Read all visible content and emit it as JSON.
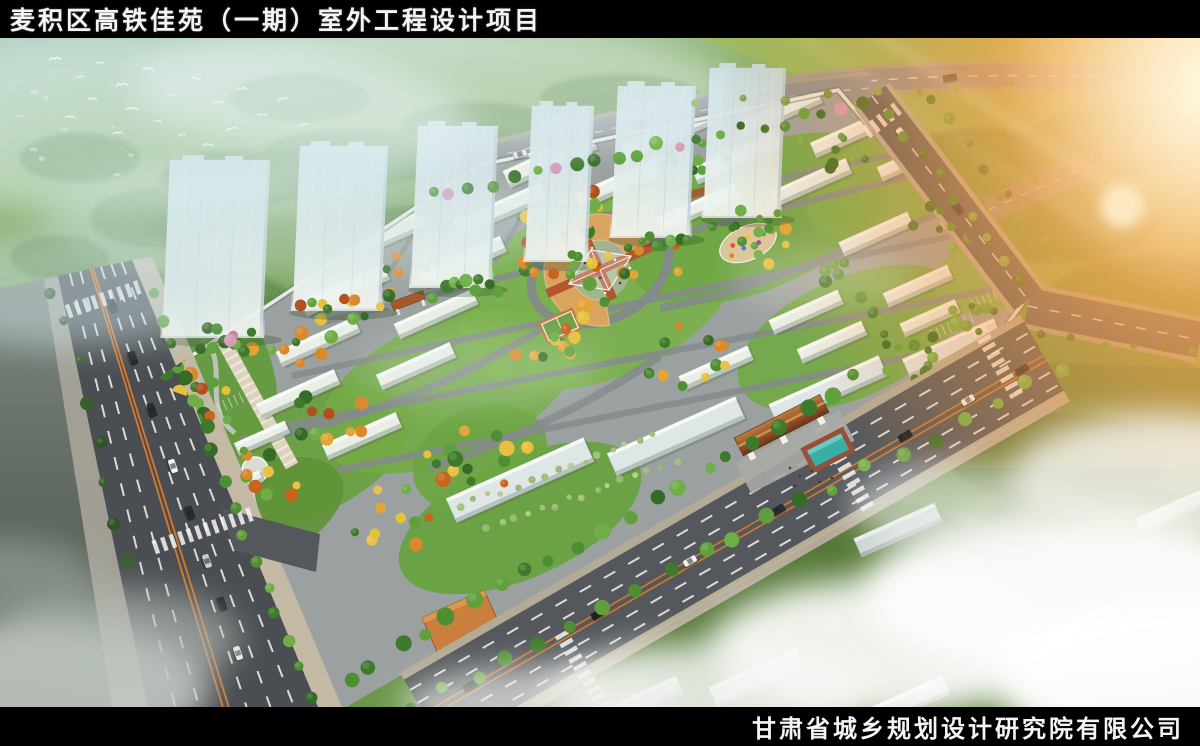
{
  "header": {
    "title": "麦积区高铁佳苑（一期）室外工程设计项目"
  },
  "footer": {
    "company": "甘肃省城乡规划设计研究院有限公司"
  },
  "palette": {
    "bar_background": "#000000",
    "bar_text": "#f4f4f4",
    "asphalt": "#54585c",
    "road_marking_orange": "#e07b28",
    "sidewalk_beige": "#b3ab97",
    "lawn_green": "#6fa044",
    "tree_green": "#4f8a33",
    "autumn_orange": "#c9641f",
    "autumn_yellow": "#e7b33c",
    "tower_glass": "#d3e4e9",
    "roof_terracotta": "#8a4a26",
    "plaza_tan": "#d9a360",
    "pool_teal": "#3aada6",
    "mist_white": "#f2f6f4",
    "sun_glare": "#ffb35c"
  }
}
